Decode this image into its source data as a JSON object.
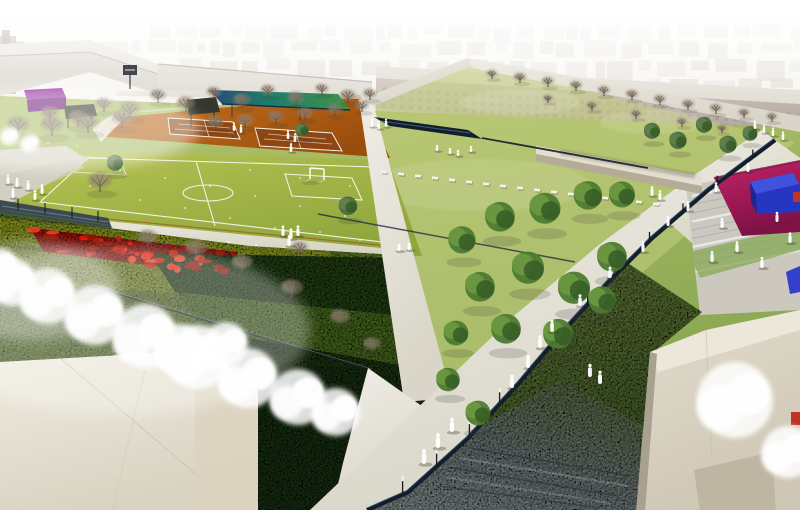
{
  "description": "Aerial architectural rendering of an urban park masterplan with sports fields, tennis courts, gardens, promenades and surrounding city blocks",
  "palette": {
    "haze_top": "#ffffff",
    "haze_low": "#e7e2d6",
    "distant_a": "#d9d4c7",
    "distant_b": "#c9c3b4",
    "bldg_roof": "#dad5c8",
    "bldg_wall": "#c7c1b2",
    "bldg_wall2": "#cdc7b9",
    "bldg_edge": "#6a645a",
    "bldg_dark": "#8c857a",
    "facade_hi": "#ac9c8a",
    "facade_lo": "#97877a",
    "facade_roofband": "#cfc9ba",
    "window": "#6b6054",
    "lawn_hi": "#b2c36c",
    "lawn_lo": "#7fa04a",
    "central_tint": "#c3cd7e",
    "orange_hi": "#c9731e",
    "orange_lo": "#9a4e0d",
    "court": "#8d4512",
    "court_line": "#f5f2e8",
    "pitch_hi": "#b7c354",
    "pitch_lo": "#8fa63c",
    "marking": "#ffffff",
    "russet": "#9a5a20",
    "path_hi": "#efede6",
    "path_lo": "#d9d5c8",
    "plaza": "#ccc8bd",
    "left_plaza": "#d9d5c8",
    "left_band": "#cfccbe",
    "wall_top": "#e3decf",
    "wall_side": "#b4ab99",
    "fence": "#3c4a50",
    "fence_hl": "#7fa2b5",
    "hedge_strip": "#435c2a",
    "garden_base": "#7da23c",
    "band_yellow": "#b8c831",
    "band_lime": "#a3bc2e",
    "band_olive": "#7b9c38",
    "band_dark1": "#33571f",
    "band_mid1": "#5f8a2c",
    "band_dark2": "#2b481b",
    "band_mid2": "#67912e",
    "band_dark3": "#24401a",
    "red_flower": "#cf1507",
    "hedge_bottom": "#24421c",
    "navy": "#141e2a",
    "navy_hl": "#4a7aa8",
    "meadow_hi": "#8aa84e",
    "meadow_lo": "#55743a",
    "water_hi": "#6f8a52",
    "water_mid": "#8e9b9d",
    "water_lo": "#aab6b6",
    "water_line": "#2c3539",
    "pink": "#c32368",
    "pink_dark": "#7e1145",
    "blue_top": "#4052e0",
    "blue_front": "#2636c0",
    "blue_side": "#1b2894",
    "blue_sliver": "#3340cc",
    "purple_top": "#9b34a3",
    "purple_front": "#6f1d7a",
    "teal_a": "#2b4a78",
    "teal_b": "#1f7a6e",
    "teal_c": "#3f9448",
    "shelter": "#34382f",
    "bldgBL_hi": "#f0ece0",
    "bldgBL_lo": "#d9d2c2",
    "bldgBR_hi": "#e2dccd",
    "bldgBR_lo": "#cfc7b5",
    "bldg_facet": "#ece7da",
    "bldg_shadow": "#a9a190",
    "notch": "#b9b09e",
    "accent_red": "#c23326",
    "step_light": "#e9f1f5",
    "step_blue": "#9db6c6",
    "steps_green": "#85a855",
    "branch": "#4f463d",
    "bare_leaf_a": "#8a7c6a",
    "bare_leaf_b": "#99897a",
    "green_a": "#4d7a31",
    "green_b": "#6b9940",
    "green_c": "#365c26",
    "olive_a": "#4c6b40",
    "olive_b": "#5f8050",
    "blossom": "#ffffff",
    "person": "#ffffff",
    "lamp": "#1c1c1c",
    "bench_block": "#f4f2ec",
    "shadow": "#3a3a30"
  },
  "scene": {
    "skyline_rows": [
      {
        "y": 26,
        "h": 12,
        "x0": 150,
        "x1": 800,
        "op": 0.4,
        "seed": 11
      },
      {
        "y": 42,
        "h": 14,
        "x0": 0,
        "x1": 800,
        "op": 0.5,
        "seed": 22
      },
      {
        "y": 60,
        "h": 16,
        "x0": 180,
        "x1": 800,
        "op": 0.6,
        "seed": 33
      },
      {
        "y": 80,
        "h": 13,
        "x0": 380,
        "x1": 800,
        "op": 0.65,
        "seed": 44
      }
    ],
    "windows": {
      "x0": 382,
      "x1": 795,
      "step": 9,
      "rows": 3,
      "row_gap": 8,
      "w": 4,
      "h": 4.5,
      "op": 0.42
    },
    "trees": {
      "bare": [
        [
          50,
          122,
          15
        ],
        [
          78,
          127,
          16
        ],
        [
          104,
          112,
          14
        ],
        [
          130,
          119,
          17
        ],
        [
          158,
          103,
          13
        ],
        [
          186,
          112,
          15
        ],
        [
          214,
          99,
          12
        ],
        [
          242,
          108,
          14
        ],
        [
          268,
          97,
          12
        ],
        [
          296,
          106,
          14
        ],
        [
          322,
          95,
          11
        ],
        [
          348,
          103,
          13
        ],
        [
          370,
          100,
          11
        ],
        [
          216,
          130,
          14
        ],
        [
          245,
          128,
          13
        ],
        [
          276,
          124,
          13
        ],
        [
          305,
          120,
          12
        ],
        [
          335,
          116,
          12
        ],
        [
          362,
          112,
          11
        ],
        [
          18,
          135,
          18
        ],
        [
          52,
          136,
          19
        ],
        [
          88,
          133,
          18
        ],
        [
          122,
          128,
          17
        ],
        [
          100,
          192,
          19
        ],
        [
          492,
          79,
          9
        ],
        [
          520,
          83,
          10
        ],
        [
          548,
          87,
          10
        ],
        [
          576,
          91,
          10
        ],
        [
          604,
          96,
          10
        ],
        [
          632,
          100,
          10
        ],
        [
          660,
          105,
          10
        ],
        [
          688,
          110,
          10
        ],
        [
          716,
          114,
          10
        ],
        [
          744,
          118,
          9
        ],
        [
          772,
          122,
          9
        ],
        [
          548,
          103,
          8
        ],
        [
          592,
          111,
          9
        ],
        [
          636,
          119,
          9
        ],
        [
          682,
          127,
          9
        ],
        [
          722,
          133,
          8
        ],
        [
          148,
          246,
          16
        ],
        [
          196,
          258,
          18
        ],
        [
          242,
          272,
          17
        ],
        [
          292,
          298,
          18
        ],
        [
          340,
          326,
          16
        ],
        [
          300,
          255,
          13
        ],
        [
          372,
          352,
          14
        ]
      ],
      "green": [
        [
          462,
          252,
          22
        ],
        [
          500,
          230,
          24
        ],
        [
          545,
          222,
          25
        ],
        [
          588,
          208,
          23
        ],
        [
          622,
          206,
          21
        ],
        [
          480,
          300,
          24
        ],
        [
          528,
          282,
          26
        ],
        [
          574,
          302,
          26
        ],
        [
          612,
          270,
          24
        ],
        [
          456,
          344,
          20
        ],
        [
          506,
          342,
          24
        ],
        [
          558,
          347,
          24
        ],
        [
          602,
          312,
          22
        ],
        [
          448,
          390,
          19
        ],
        [
          478,
          424,
          20
        ]
      ],
      "olive": [
        [
          652,
          138,
          13
        ],
        [
          678,
          148,
          14
        ],
        [
          704,
          132,
          13
        ],
        [
          728,
          152,
          14
        ],
        [
          750,
          140,
          12
        ],
        [
          115,
          170,
          13
        ],
        [
          348,
          214,
          15
        ],
        [
          302,
          136,
          11
        ]
      ],
      "blossom": [
        [
          12,
          282,
          24
        ],
        [
          48,
          296,
          28
        ],
        [
          95,
          315,
          30
        ],
        [
          145,
          336,
          32
        ],
        [
          198,
          357,
          32
        ],
        [
          248,
          378,
          30
        ],
        [
          298,
          397,
          28
        ],
        [
          336,
          412,
          24
        ],
        [
          0,
          266,
          18
        ],
        [
          735,
          400,
          38
        ],
        [
          788,
          452,
          26
        ],
        [
          10,
          136,
          9
        ],
        [
          30,
          143,
          9
        ],
        [
          226,
          344,
          22
        ],
        [
          180,
          350,
          26
        ]
      ]
    },
    "people": [
      [
        8,
        184
      ],
      [
        17,
        187
      ],
      [
        28,
        190
      ],
      [
        42,
        194
      ],
      [
        13,
        198
      ],
      [
        35,
        200
      ],
      [
        234,
        131
      ],
      [
        241,
        133
      ],
      [
        288,
        139
      ],
      [
        295,
        142
      ],
      [
        291,
        152
      ],
      [
        283,
        236
      ],
      [
        291,
        239
      ],
      [
        298,
        236
      ],
      [
        289,
        246
      ],
      [
        399,
        251,
        "sit"
      ],
      [
        409,
        250,
        "sit"
      ],
      [
        450,
        154,
        "sit"
      ],
      [
        458,
        156,
        "sit"
      ],
      [
        471,
        152,
        "sit"
      ],
      [
        437,
        151,
        "sit"
      ],
      [
        372,
        127
      ],
      [
        379,
        129
      ],
      [
        386,
        127
      ],
      [
        755,
        129
      ],
      [
        764,
        133
      ],
      [
        773,
        136
      ],
      [
        783,
        140
      ],
      [
        748,
        172
      ],
      [
        716,
        192
      ],
      [
        688,
        211
      ],
      [
        668,
        226
      ],
      [
        652,
        196
      ],
      [
        660,
        200
      ],
      [
        643,
        252
      ],
      [
        610,
        278
      ],
      [
        580,
        306
      ],
      [
        552,
        332
      ],
      [
        540,
        348
      ],
      [
        528,
        368
      ],
      [
        512,
        388
      ],
      [
        452,
        432
      ],
      [
        438,
        448
      ],
      [
        424,
        464
      ],
      [
        590,
        377
      ],
      [
        600,
        384
      ],
      [
        722,
        228
      ],
      [
        737,
        252
      ],
      [
        762,
        268
      ],
      [
        777,
        222
      ],
      [
        790,
        243
      ],
      [
        712,
        262
      ]
    ],
    "channel": [
      [
        775,
        140
      ],
      [
        708,
        190
      ],
      [
        652,
        238
      ],
      [
        608,
        282
      ],
      [
        562,
        332
      ],
      [
        518,
        384
      ],
      [
        468,
        438
      ],
      [
        408,
        492
      ],
      [
        367,
        510
      ]
    ],
    "lamp_fractions": [
      0.05,
      0.13,
      0.21,
      0.29,
      0.37,
      0.45,
      0.53,
      0.61,
      0.69,
      0.77,
      0.85,
      0.93
    ],
    "bench": {
      "x0": 384,
      "y0": 172,
      "x1": 656,
      "y1": 204,
      "n": 17
    },
    "bollards": {
      "x0": 92,
      "y0": 227,
      "x1": 366,
      "y1": 258,
      "n": 11
    },
    "steps": {
      "x0": 692,
      "y0": 196,
      "x1": 800,
      "y1": 174,
      "n": 10,
      "dy": 8.5
    },
    "flowers": {
      "quad": [
        30,
        228,
        238,
        252,
        230,
        276,
        44,
        252
      ],
      "n": 55,
      "seed": 7,
      "colors": [
        "#e01505",
        "#c11004",
        "#f2401f",
        "#8f1004"
      ]
    },
    "pitch_dots": [
      [
        120,
        170
      ],
      [
        165,
        178
      ],
      [
        210,
        186
      ],
      [
        255,
        196
      ],
      [
        300,
        206
      ],
      [
        345,
        216
      ],
      [
        140,
        200
      ],
      [
        185,
        208
      ],
      [
        230,
        218
      ],
      [
        275,
        228
      ],
      [
        90,
        186
      ],
      [
        320,
        232
      ],
      [
        360,
        240
      ],
      [
        48,
        143
      ],
      [
        77,
        146
      ],
      [
        250,
        170
      ],
      [
        300,
        178
      ],
      [
        350,
        186
      ]
    ]
  }
}
